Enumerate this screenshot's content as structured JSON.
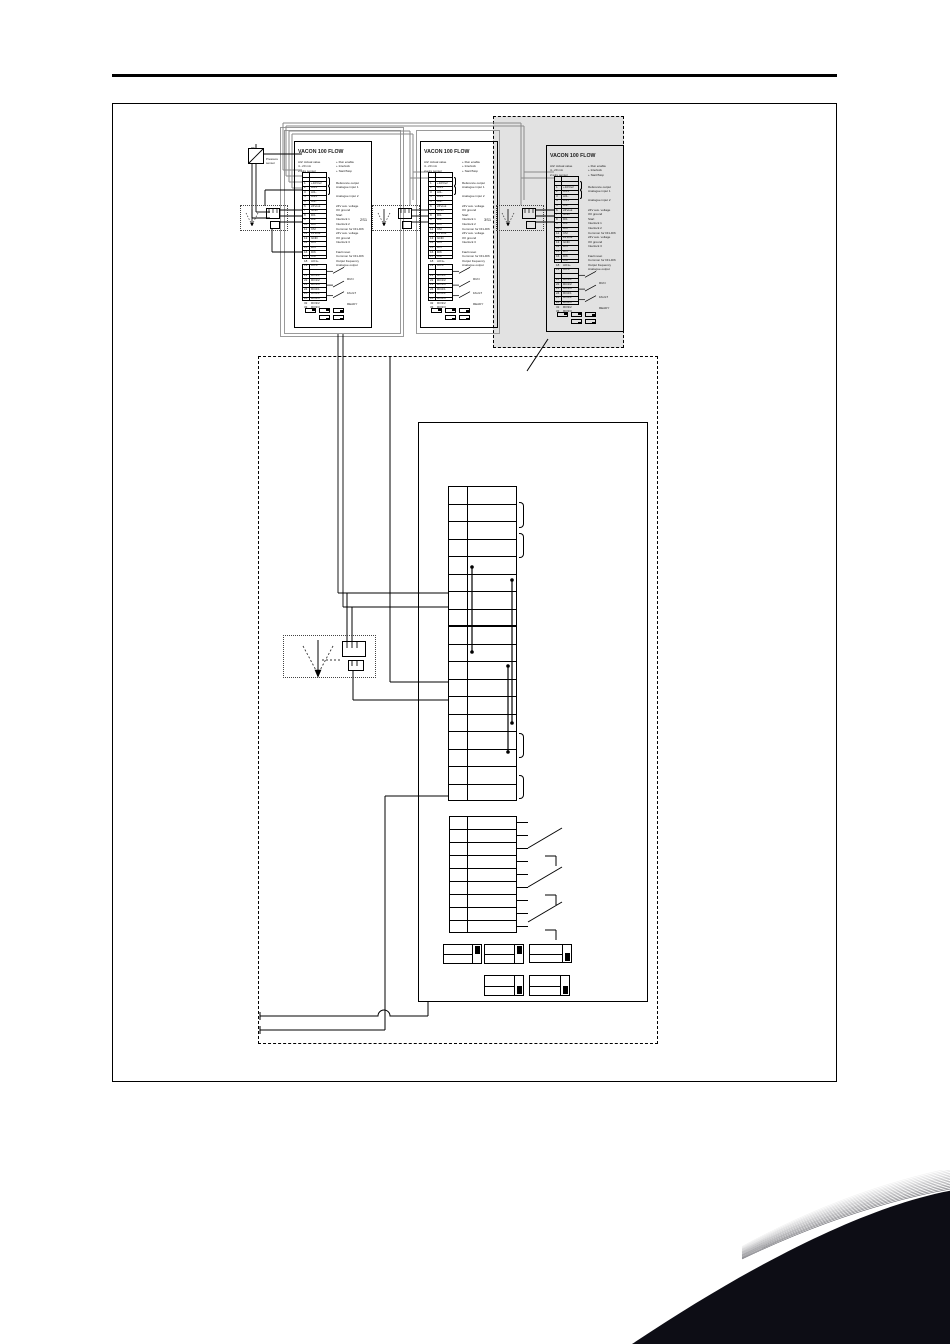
{
  "page": {
    "background": "#ffffff"
  },
  "colors": {
    "line": "#1a1a1a",
    "wire_gray": "#8a8a8a",
    "panel_gray": "#e2e2e2",
    "swoosh": "#0d0d15"
  },
  "figure": {
    "drives": [
      {
        "title": "VACON 100 FLOW",
        "sensor_ref": ""
      },
      {
        "title": "VACON 100 FLOW",
        "sensor_ref": "2S1"
      },
      {
        "title": "VACON 100 FLOW",
        "sensor_ref": "3S1"
      }
    ],
    "transducer": {
      "top_label": "PT",
      "side_label_1": "Pressure",
      "side_label_2": "sensor"
    },
    "io_board": {
      "notes_left": [
        "AI2: Actual value",
        "4...20 mA",
        "2-wire sensor"
      ],
      "notes_right": [
        "+ Run enable",
        "+ Interlock",
        "+ Start/Stop"
      ],
      "terminals": [
        {
          "n": "1",
          "name": "+10Vref",
          "desc": "Reference output"
        },
        {
          "n": "2",
          "name": "AI1+",
          "desc": "Analogue input 1"
        },
        {
          "n": "3",
          "name": "AI1-",
          "desc": ""
        },
        {
          "n": "4",
          "name": "AI2+",
          "desc": "Analogue input 2"
        },
        {
          "n": "5",
          "name": "AI2-",
          "desc": ""
        },
        {
          "n": "6",
          "name": "24Vout",
          "desc": "24V aux. voltage"
        },
        {
          "n": "7",
          "name": "GND",
          "desc": "I/O ground"
        },
        {
          "n": "8",
          "name": "DI1",
          "desc": "Start"
        },
        {
          "n": "9",
          "name": "DI2",
          "desc": "Interlock 1"
        },
        {
          "n": "10",
          "name": "DI3",
          "desc": "Interlock 2"
        },
        {
          "n": "11",
          "name": "CM",
          "desc": "Common for DI1-DI6"
        },
        {
          "n": "12",
          "name": "24Vout",
          "desc": "24V aux. voltage"
        },
        {
          "n": "13",
          "name": "GND",
          "desc": "I/O ground"
        },
        {
          "n": "14",
          "name": "DI4",
          "desc": "Interlock 3"
        },
        {
          "n": "15",
          "name": "DI5",
          "desc": ""
        },
        {
          "n": "16",
          "name": "DI6",
          "desc": "Fault reset"
        },
        {
          "n": "17",
          "name": "CM",
          "desc": "Common for DI1-DI6"
        },
        {
          "n": "18",
          "name": "AO1+",
          "desc": "Output frequency"
        },
        {
          "n": "19",
          "name": "AO1-",
          "desc": "Analogue output"
        }
      ],
      "relays": [
        {
          "n": "21",
          "name": "RO1/1"
        },
        {
          "n": "22",
          "name": "RO1/2"
        },
        {
          "n": "23",
          "name": "RO1/3"
        },
        {
          "n": "24",
          "name": "RO2/1"
        },
        {
          "n": "25",
          "name": "RO2/2"
        },
        {
          "n": "26",
          "name": "RO2/3"
        },
        {
          "n": "32",
          "name": "RO3/2"
        },
        {
          "n": "33",
          "name": "RO3/3"
        }
      ],
      "relay_groups": [
        "RUN",
        "FAULT",
        "READY"
      ]
    },
    "detail": {
      "main_rows": 18,
      "relay_rows": 9,
      "dip_switches_top": 3,
      "dip_switches_bottom": 2
    }
  }
}
